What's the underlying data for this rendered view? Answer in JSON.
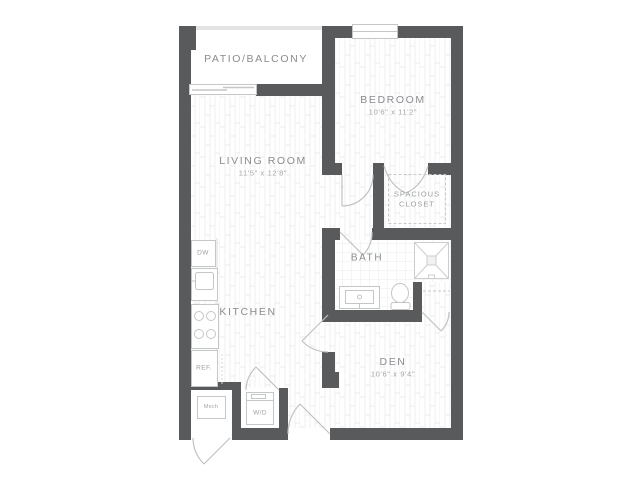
{
  "plan": {
    "title": "one-bedroom-with-den-floor-plan",
    "colors": {
      "wall": "#595a5c",
      "fixture_line": "#c5c6c8",
      "room_text": "#8a8c8f",
      "dims_text": "#a3a5a7",
      "floor": "#ffffff"
    },
    "rooms": {
      "patio": {
        "name": "PATIO/BALCONY"
      },
      "bedroom": {
        "name": "BEDROOM",
        "dims": "10'6\" x 11'2\""
      },
      "living": {
        "name": "LIVING ROOM",
        "dims": "11'5\" x 12'8\""
      },
      "closet": {
        "line1": "SPACIOUS",
        "line2": "CLOSET"
      },
      "bath": {
        "name": "BATH"
      },
      "kitchen": {
        "name": "KITCHEN"
      },
      "den": {
        "name": "DEN",
        "dims": "10'6\" x 9'4\""
      }
    },
    "fixtures": {
      "dishwasher": "DW",
      "refrigerator": "REF.",
      "mechanical": "Mech",
      "washer_dryer": "W/D"
    }
  }
}
